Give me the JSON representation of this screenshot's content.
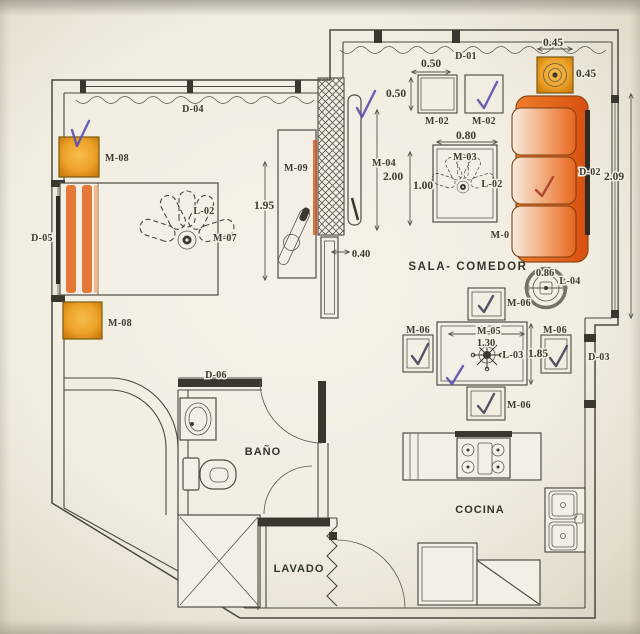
{
  "plan": {
    "labels": {
      "d01": "D-01",
      "d02": "D-02",
      "d03": "D-03",
      "d04": "D-04",
      "d05": "D-05",
      "d06": "D-06",
      "m01": "M-0",
      "m02a": "M-02",
      "m02b": "M-02",
      "m03": "M-03",
      "m04": "M-04",
      "m05": "M-05",
      "m06a": "M-06",
      "m06b": "M-06",
      "m06c": "M-06",
      "m06d": "M-06",
      "m07": "M-07",
      "m08a": "M-08",
      "m08b": "M-08",
      "m09": "M-09",
      "l02a": "L-02",
      "l02b": "L-02",
      "l03": "L-03",
      "l04": "L-04",
      "sala": "SALA- COMEDOR",
      "bano": "BAÑO",
      "cocina": "COCINA",
      "lavado": "LAVADO"
    },
    "dims": {
      "d050a": "0.50",
      "d050b": "0.50",
      "d080": "0.80",
      "d200": "2.00",
      "d100": "1.00",
      "d195": "1.95",
      "d040": "0.40",
      "d045a": "0.45",
      "d045b": "0.45",
      "d209": "2.09",
      "d086": "0.86",
      "d130": "1.30",
      "d185": "1.85"
    },
    "colors": {
      "paper": "#f2eee2",
      "line": "#4a4940",
      "sofa_orange": "#e8641c",
      "amber": "#eda228",
      "chair_beige": "#d8d0b5",
      "check_purple": "#5a4fae",
      "check_red": "#a93b2a"
    }
  }
}
